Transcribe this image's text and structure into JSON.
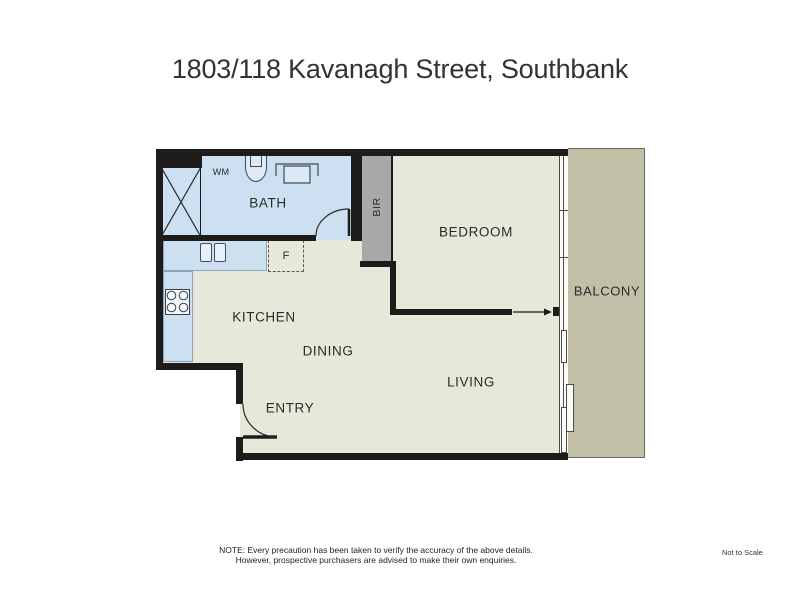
{
  "title": "1803/118 Kavanagh Street, Southbank",
  "rooms": {
    "bath": "BATH",
    "bir": "BIR",
    "bedroom": "BEDROOM",
    "balcony": "BALCONY",
    "kitchen": "KITCHEN",
    "dining": "DINING",
    "living": "LIVING",
    "entry": "ENTRY"
  },
  "fixtures": {
    "washing_machine": "WM",
    "fridge": "F"
  },
  "footer": {
    "note_line1": "NOTE: Every precaution has been taken to verify the accuracy of the above details.",
    "note_line2": "However, prospective purchasers are advised to make their own enquiries.",
    "scale": "Not to Scale"
  },
  "colors": {
    "wall": "#1d1c1a",
    "wet": "#cde0f1",
    "floor": "#e8e8da",
    "robe": "#a8a8ab",
    "balcony": "#c1bfa8",
    "ink": "#2b2b27"
  }
}
